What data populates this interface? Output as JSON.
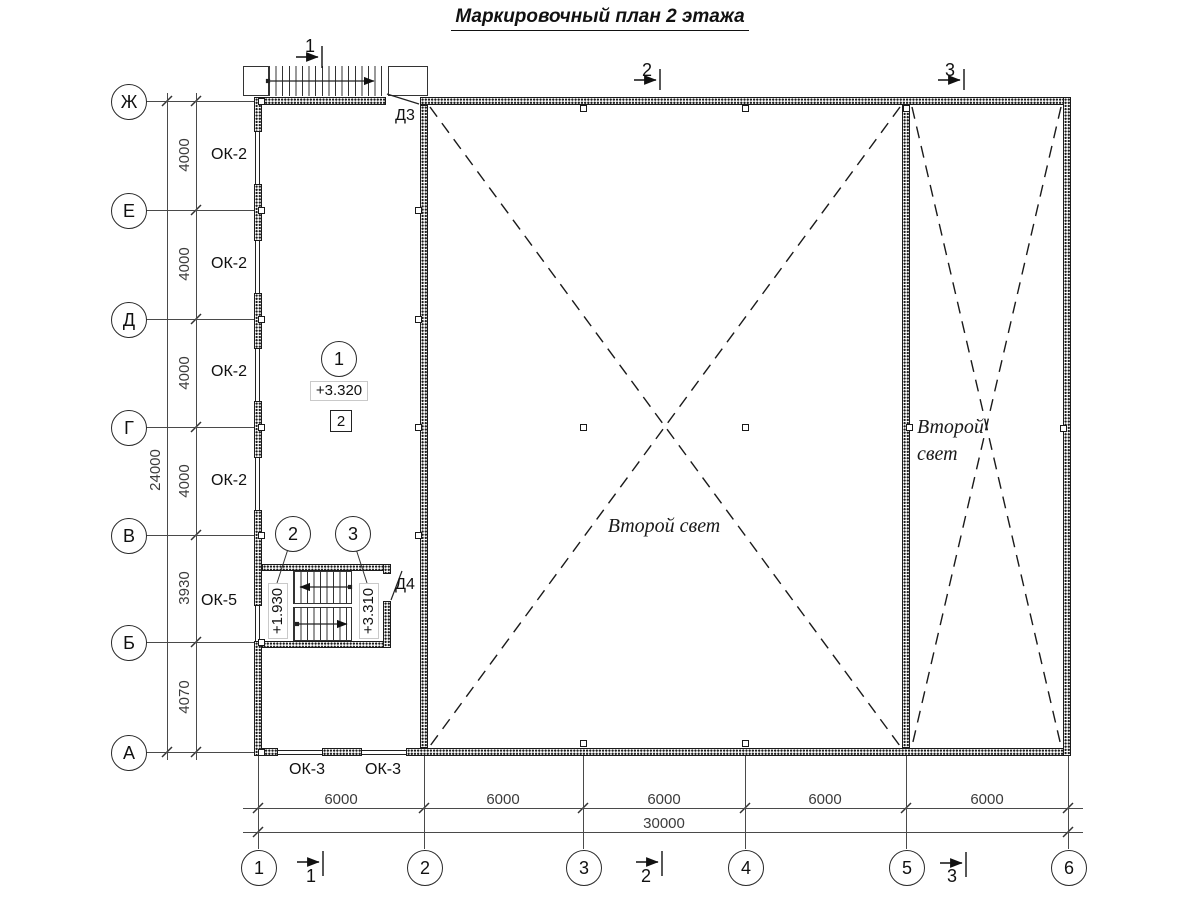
{
  "title": "Маркировочный план 2 этажа",
  "axes": {
    "rows": [
      {
        "label": "Ж"
      },
      {
        "label": "Е"
      },
      {
        "label": "Д"
      },
      {
        "label": "Г"
      },
      {
        "label": "В"
      },
      {
        "label": "Б"
      },
      {
        "label": "А"
      }
    ],
    "cols": [
      {
        "label": "1"
      },
      {
        "label": "2"
      },
      {
        "label": "3"
      },
      {
        "label": "4"
      },
      {
        "label": "5"
      },
      {
        "label": "6"
      }
    ]
  },
  "dims": {
    "v_segments": [
      "4000",
      "4000",
      "4000",
      "4000",
      "3930",
      "4070"
    ],
    "v_total": "24000",
    "h_segments": [
      "6000",
      "6000",
      "6000",
      "6000",
      "6000"
    ],
    "h_total": "30000"
  },
  "windows": {
    "left": [
      "ОК-2",
      "ОК-2",
      "ОК-2",
      "ОК-2"
    ],
    "stair": "ОК-5",
    "bottom": [
      "ОК-3",
      "ОК-3"
    ]
  },
  "doors": {
    "top": "Д3",
    "stair": "Д4"
  },
  "levels": {
    "floor": "+3.320",
    "stair_landing": "+1.930",
    "stair_top": "+3.310"
  },
  "markers": {
    "room_circle": "1",
    "room_box": "2",
    "stair_left": "2",
    "stair_right": "3"
  },
  "sections": {
    "s1": "1",
    "s2": "2",
    "s3": "3"
  },
  "notes": {
    "second_light": "Второй свет",
    "second_light_l1": "Второй",
    "second_light_l2": "свет"
  }
}
